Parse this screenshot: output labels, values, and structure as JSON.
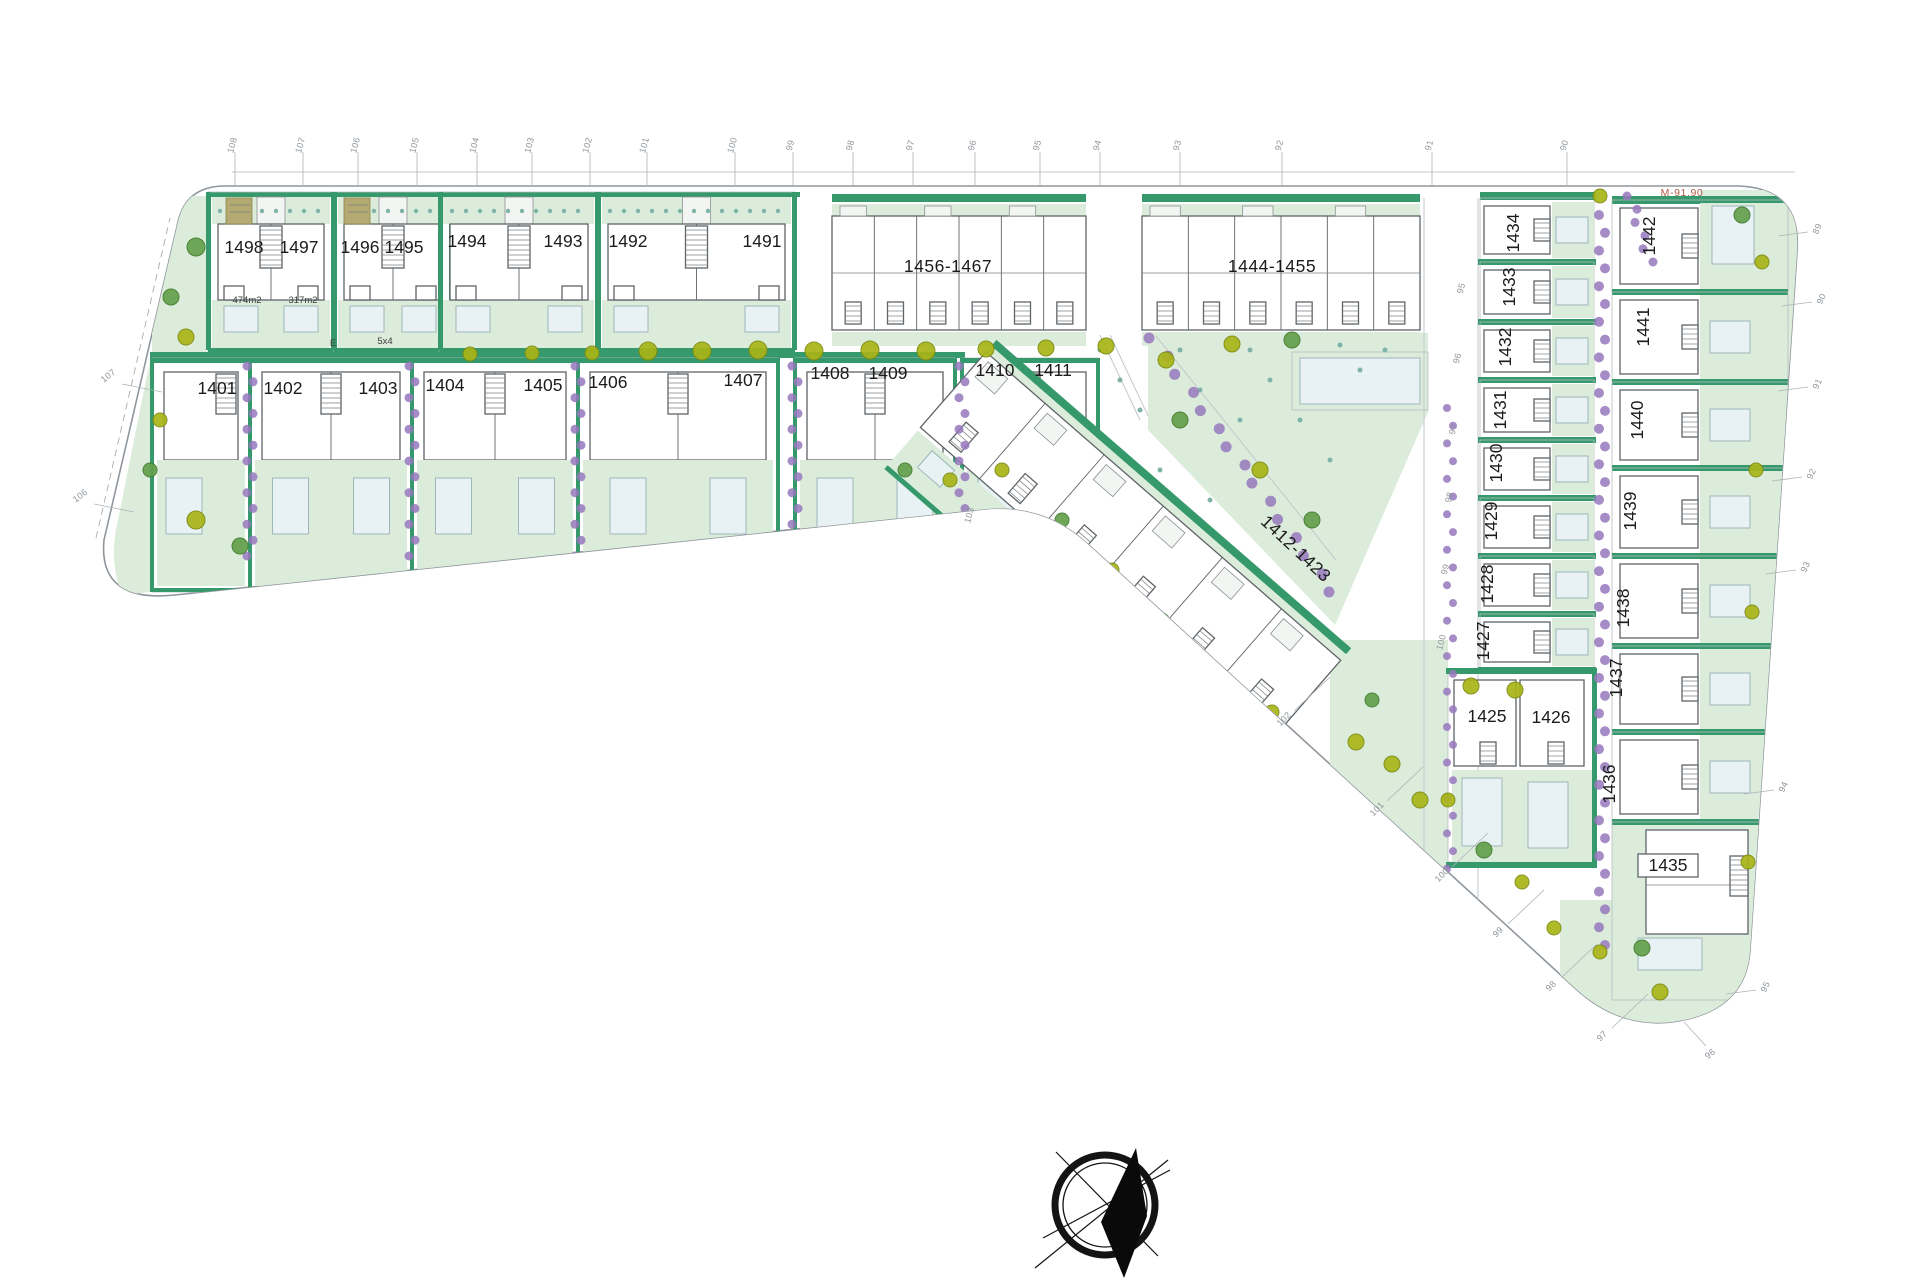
{
  "parcel": {
    "label": "M-91.90"
  },
  "plots": {
    "row1": [
      {
        "label": "1498",
        "x": 244,
        "y": 253
      },
      {
        "label": "1497",
        "x": 299,
        "y": 253
      },
      {
        "label": "1496",
        "x": 360,
        "y": 253
      },
      {
        "label": "1495",
        "x": 404,
        "y": 253
      },
      {
        "label": "1494",
        "x": 467,
        "y": 247
      },
      {
        "label": "1493",
        "x": 563,
        "y": 247
      },
      {
        "label": "1492",
        "x": 628,
        "y": 247
      },
      {
        "label": "1491",
        "x": 762,
        "y": 247
      }
    ],
    "row2": [
      {
        "label": "1401",
        "x": 217,
        "y": 394
      },
      {
        "label": "1402",
        "x": 283,
        "y": 394
      },
      {
        "label": "1403",
        "x": 378,
        "y": 394
      },
      {
        "label": "1404",
        "x": 445,
        "y": 391
      },
      {
        "label": "1405",
        "x": 543,
        "y": 391
      },
      {
        "label": "1406",
        "x": 608,
        "y": 388
      },
      {
        "label": "1407",
        "x": 743,
        "y": 386
      },
      {
        "label": "1408",
        "x": 830,
        "y": 379
      },
      {
        "label": "1409",
        "x": 888,
        "y": 379
      },
      {
        "label": "1410",
        "x": 995,
        "y": 376
      },
      {
        "label": "1411",
        "x": 1053,
        "y": 376
      }
    ],
    "col_mid": [
      {
        "label": "1434",
        "x": 1519,
        "y": 233,
        "rot": -90
      },
      {
        "label": "1433",
        "x": 1515,
        "y": 287,
        "rot": -90
      },
      {
        "label": "1432",
        "x": 1511,
        "y": 347,
        "rot": -90
      },
      {
        "label": "1431",
        "x": 1506,
        "y": 410,
        "rot": -90
      },
      {
        "label": "1430",
        "x": 1502,
        "y": 463,
        "rot": -90
      },
      {
        "label": "1429",
        "x": 1497,
        "y": 521,
        "rot": -90
      },
      {
        "label": "1428",
        "x": 1493,
        "y": 584,
        "rot": -90
      },
      {
        "label": "1427",
        "x": 1489,
        "y": 641,
        "rot": -90
      }
    ],
    "col_right": [
      {
        "label": "1442",
        "x": 1655,
        "y": 236,
        "rot": -90
      },
      {
        "label": "1441",
        "x": 1649,
        "y": 327,
        "rot": -90
      },
      {
        "label": "1440",
        "x": 1643,
        "y": 420,
        "rot": -90
      },
      {
        "label": "1439",
        "x": 1636,
        "y": 511,
        "rot": -90
      },
      {
        "label": "1438",
        "x": 1629,
        "y": 608,
        "rot": -90
      },
      {
        "label": "1437",
        "x": 1622,
        "y": 678,
        "rot": -90
      },
      {
        "label": "1436",
        "x": 1615,
        "y": 784,
        "rot": -90
      }
    ],
    "bottom": [
      {
        "label": "1425",
        "x": 1487,
        "y": 722,
        "rot": 0
      },
      {
        "label": "1426",
        "x": 1551,
        "y": 723,
        "rot": 0
      },
      {
        "label": "1435",
        "x": 1668,
        "y": 871,
        "rot": 0
      }
    ]
  },
  "blocks": [
    {
      "label": "1456-1467",
      "x": 948,
      "y": 272,
      "rot": 0
    },
    {
      "label": "1444-1455",
      "x": 1272,
      "y": 272,
      "rot": 0
    },
    {
      "label": "1412-1423",
      "x": 1292,
      "y": 553,
      "rot": 43
    }
  ],
  "area_labels": [
    {
      "label": "474m2",
      "x": 247,
      "y": 303
    },
    {
      "label": "317m2",
      "x": 303,
      "y": 303
    },
    {
      "label": "E",
      "x": 333,
      "y": 346
    },
    {
      "label": "5x4",
      "x": 385,
      "y": 344
    }
  ],
  "markers": {
    "top": [
      {
        "n": "108",
        "x": 235
      },
      {
        "n": "107",
        "x": 303
      },
      {
        "n": "106",
        "x": 358
      },
      {
        "n": "105",
        "x": 417
      },
      {
        "n": "104",
        "x": 477
      },
      {
        "n": "103",
        "x": 532
      },
      {
        "n": "102",
        "x": 590
      },
      {
        "n": "101",
        "x": 647
      },
      {
        "n": "100",
        "x": 735
      },
      {
        "n": "99",
        "x": 793
      },
      {
        "n": "98",
        "x": 853
      },
      {
        "n": "97",
        "x": 913
      },
      {
        "n": "96",
        "x": 975
      },
      {
        "n": "95",
        "x": 1040
      },
      {
        "n": "94",
        "x": 1100
      },
      {
        "n": "93",
        "x": 1180
      },
      {
        "n": "92",
        "x": 1282
      },
      {
        "n": "91",
        "x": 1432
      },
      {
        "n": "90",
        "x": 1567
      }
    ],
    "left": [
      {
        "n": "107",
        "x": 110,
        "y": 378
      },
      {
        "n": "106",
        "x": 82,
        "y": 498
      }
    ],
    "right": [
      {
        "n": "89",
        "x": 1820,
        "y": 230
      },
      {
        "n": "90",
        "x": 1824,
        "y": 300
      },
      {
        "n": "91",
        "x": 1820,
        "y": 385
      },
      {
        "n": "92",
        "x": 1814,
        "y": 475
      },
      {
        "n": "93",
        "x": 1808,
        "y": 568
      },
      {
        "n": "94",
        "x": 1786,
        "y": 788
      },
      {
        "n": "95",
        "x": 1768,
        "y": 988
      }
    ],
    "diagonal": [
      {
        "n": "102",
        "x": 1286,
        "y": 721
      },
      {
        "n": "101",
        "x": 1379,
        "y": 811
      },
      {
        "n": "100",
        "x": 1444,
        "y": 877
      },
      {
        "n": "99",
        "x": 1500,
        "y": 934
      },
      {
        "n": "98",
        "x": 1553,
        "y": 988
      },
      {
        "n": "97",
        "x": 1604,
        "y": 1038
      }
    ],
    "bottom": [
      {
        "n": "96",
        "x": 1712,
        "y": 1056
      }
    ],
    "inner_road": [
      {
        "n": "95",
        "x": 1464,
        "y": 289
      },
      {
        "n": "96",
        "x": 1460,
        "y": 359
      },
      {
        "n": "97",
        "x": 1456,
        "y": 430
      },
      {
        "n": "98",
        "x": 1452,
        "y": 498
      },
      {
        "n": "99",
        "x": 1448,
        "y": 570
      },
      {
        "n": "100",
        "x": 1444,
        "y": 643
      },
      {
        "n": "103",
        "x": 972,
        "y": 516
      }
    ]
  },
  "colors": {
    "strip_green": "#35996b",
    "garden_green": "#dcecdb",
    "pool_blue": "#e8f1f3",
    "tree_olive": "#a9b517",
    "tree_green": "#63a04b",
    "shrub_purple": "#9678bd",
    "building_outline": "#5f6468",
    "boundary_gray": "#8f969c",
    "marker_text": "#8f959a",
    "parcel_red": "#b25a4c",
    "label_black": "#1b1b1b"
  }
}
